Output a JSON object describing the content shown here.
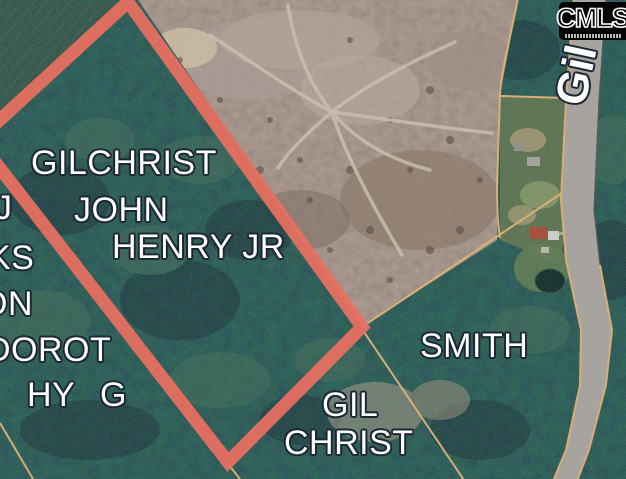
{
  "labels": {
    "gilchrist_line1": "GILCHRIST",
    "gilchrist_line2": "JOHN",
    "gilchrist_line3": "HENRY JR",
    "smith": "SMITH",
    "gilchrist2_line1": "GIL",
    "gilchrist2_line2": "CHRIST",
    "left_fragment_line1": "J",
    "left_fragment_line2": "KS",
    "left_fragment_line3": "ON",
    "left_fragment_line4": "DOROT",
    "left_fragment_line5": "HY",
    "left_fragment_line6": "G"
  },
  "road": {
    "name_label": "Gil"
  },
  "logo": {
    "text": "CMLS"
  },
  "colors": {
    "parcel-highlight": "#ec6c5b",
    "parcel-line": "#dfb173",
    "label-text": "#ffffff",
    "label-outline": "#1b2833",
    "road-fill": "#a6a29d",
    "forest-base": "#2b4540",
    "clearcut-base": "#93857d"
  }
}
